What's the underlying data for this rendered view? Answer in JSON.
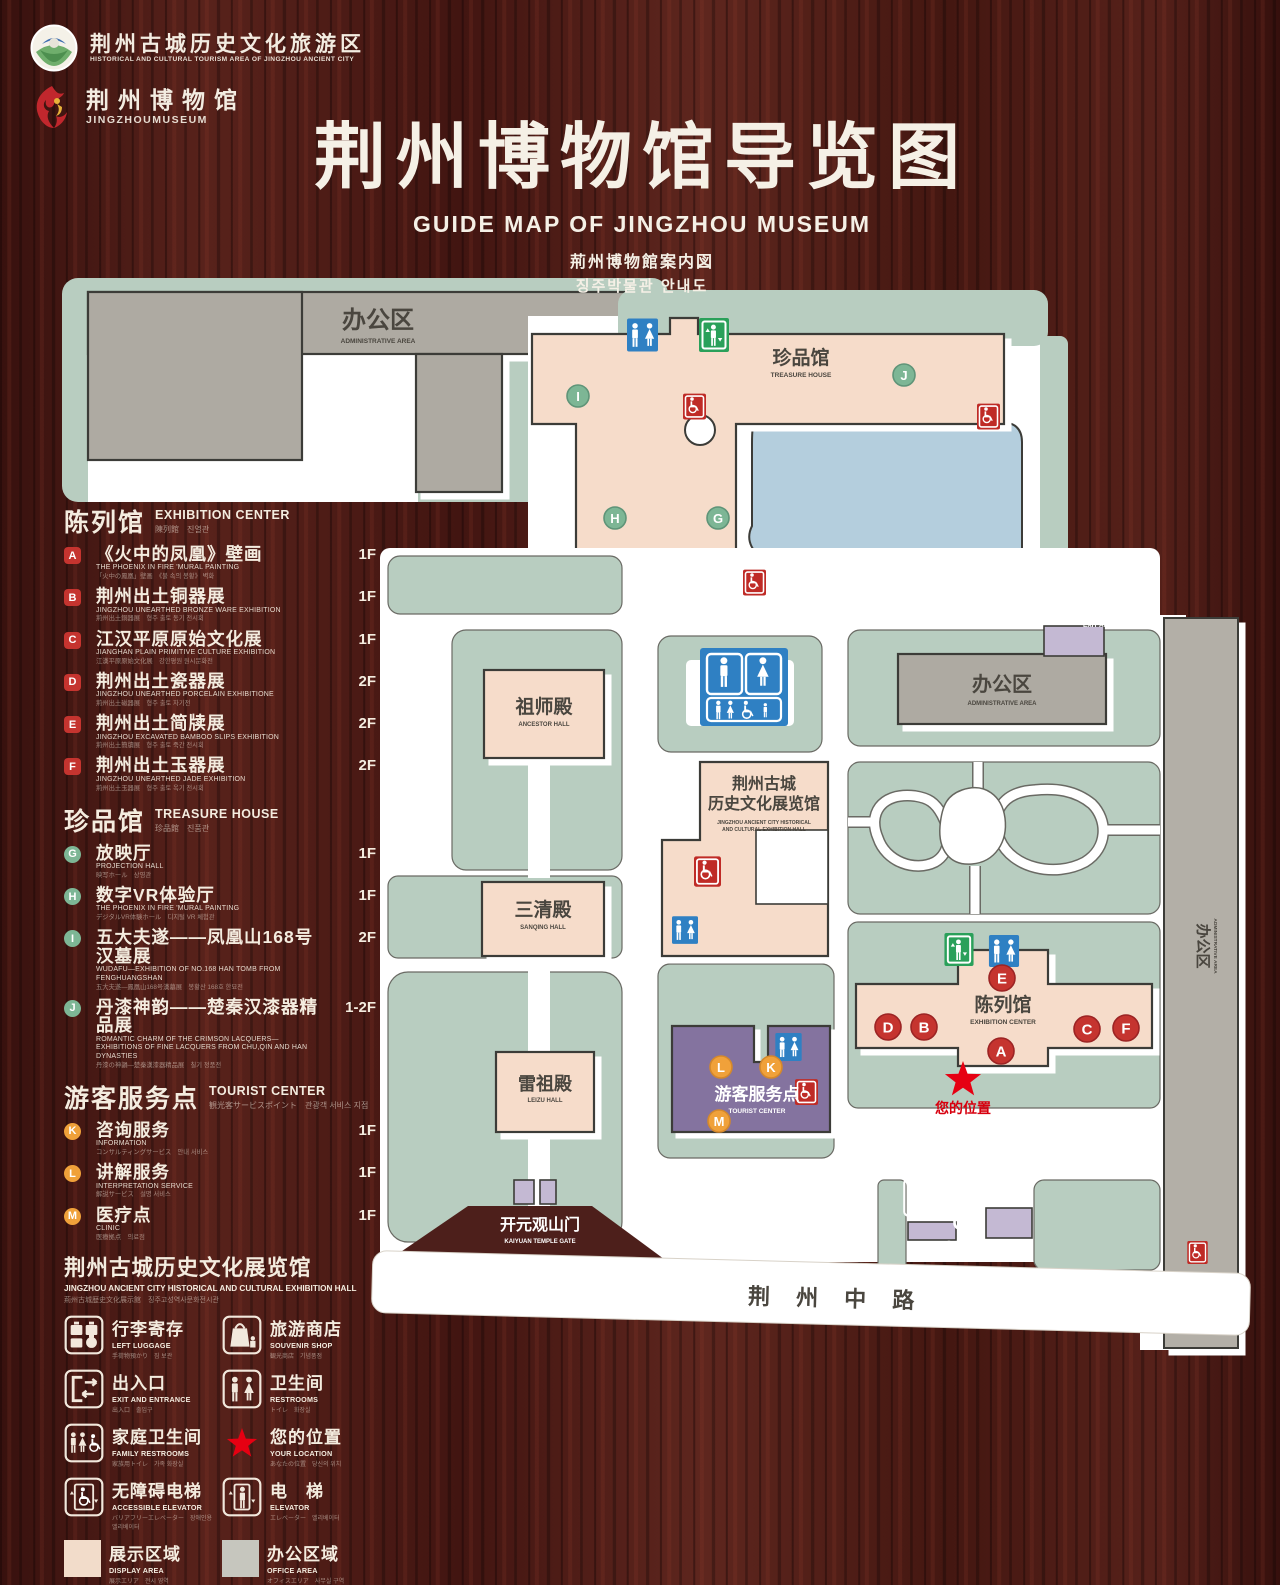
{
  "header": {
    "logo1": {
      "zh": "荆州古城历史文化旅游区",
      "en": "HISTORICAL AND CULTURAL TOURISM AREA OF JINGZHOU ANCIENT CITY"
    },
    "logo2": {
      "zh": "荆州博物馆",
      "en": "JINGZHOUMUSEUM"
    },
    "title_zh": "荆州博物馆导览图",
    "title_en": "GUIDE MAP OF JINGZHOU MUSEUM",
    "title_ja": "荊州博物館案内図",
    "title_ko": "징주박물관 안내도"
  },
  "legend": {
    "sections": [
      {
        "id": "exhibition",
        "title_zh": "陈列馆",
        "title_en": "EXHIBITION CENTER",
        "title_sub": "陳列館　진열관",
        "marker_color": "#c5342f",
        "badge_shape": "square",
        "items": [
          {
            "letter": "A",
            "zh": "《火中的凤凰》壁画",
            "en": "THE PHOENIX IN FIRE 'MURAL PAINTING",
            "sub": "「火中の鳳凰」壁画　《불 속의 봉황》 벽화",
            "floor": "1F"
          },
          {
            "letter": "B",
            "zh": "荆州出土铜器展",
            "en": "JINGZHOU UNEARTHED BRONZE WARE EXHIBITION",
            "sub": "荊州出土銅器展　형주 출토 동기 전시회",
            "floor": "1F"
          },
          {
            "letter": "C",
            "zh": "江汉平原原始文化展",
            "en": "JIANGHAN PLAIN PRIMITIVE CULTURE EXHIBITION",
            "sub": "江漢平原原始文化展　강한평원 원시문화전",
            "floor": "1F"
          },
          {
            "letter": "D",
            "zh": "荆州出土瓷器展",
            "en": "JINGZHOU UNEARTHED PORCELAIN EXHIBITIONE",
            "sub": "荊州出土磁器展　형주 출토 자기전",
            "floor": "2F"
          },
          {
            "letter": "E",
            "zh": "荆州出土简牍展",
            "en": "JINGZHOU EXCAVATED BAMBOO SLIPS EXHIBITION",
            "sub": "荊州出土簡牘展　형주 출토 죽간 전시회",
            "floor": "2F"
          },
          {
            "letter": "F",
            "zh": "荆州出土玉器展",
            "en": "JINGZHOU UNEARTHED JADE EXHIBITION",
            "sub": "荊州出土玉器展　형주 출토 옥기 전시회",
            "floor": "2F"
          }
        ]
      },
      {
        "id": "treasure",
        "title_zh": "珍品馆",
        "title_en": "TREASURE HOUSE",
        "title_sub": "珍品館　진품관",
        "marker_color": "#7db695",
        "badge_shape": "circle",
        "items": [
          {
            "letter": "G",
            "zh": "放映厅",
            "en": "PROJECTION HALL",
            "sub": "映写ホール　상영관",
            "floor": "1F"
          },
          {
            "letter": "H",
            "zh": "数字VR体验厅",
            "en": "THE PHOENIX IN FIRE 'MURAL PAINTING",
            "sub": "デジタルVR体験ホール　디지털 VR 체험관",
            "floor": "1F"
          },
          {
            "letter": "I",
            "zh": "五大夫遂——凤凰山168号汉墓展",
            "en": "WUDAFU—EXHIBITION OF NO.168 HAN TOMB FROM FENGHUANGSHAN",
            "sub": "五大夫遂—鳳凰山168号漢墓展　봉황산 168호 한묘전",
            "floor": "2F"
          },
          {
            "letter": "J",
            "zh": "丹漆神韵——楚秦汉漆器精品展",
            "en": "ROMANTIC CHARM OF THE CRIMSON LACQUERS— EXHIBITIONS OF FINE LACQUERS FROM CHU,QIN AND HAN DYNASTIES",
            "sub": "丹漆の神韻—楚秦漢漆器精品展　칠기 정품전",
            "floor": "1-2F"
          }
        ]
      },
      {
        "id": "tourist",
        "title_zh": "游客服务点",
        "title_en": "TOURIST CENTER",
        "title_sub": "観光客サービスポイント　관광객 서비스 지점",
        "marker_color": "#f0a13a",
        "badge_shape": "circle",
        "items": [
          {
            "letter": "K",
            "zh": "咨询服务",
            "en": "INFORMATION",
            "sub": "コンサルティングサービス　안내 서비스",
            "floor": "1F"
          },
          {
            "letter": "L",
            "zh": "讲解服务",
            "en": "INTERPRETATION SERVICE",
            "sub": "解説サービス　설명 서비스",
            "floor": "1F"
          },
          {
            "letter": "M",
            "zh": "医疗点",
            "en": "CLINIC",
            "sub": "医療拠点　의료점",
            "floor": "1F"
          }
        ]
      }
    ],
    "hall_note": {
      "zh": "荆州古城历史文化展览馆",
      "en": "JINGZHOU ANCIENT CITY HISTORICAL AND CULTURAL EXHIBITION HALL",
      "sub": "荊州古城歴史文化展示館　징주고성역사문화전시관"
    },
    "symbols": [
      {
        "icon": "left-luggage",
        "zh": "行李寄存",
        "en": "LEFT LUGGAGE",
        "sub": "手荷物預かり　짐 보관"
      },
      {
        "icon": "souvenir-shop",
        "zh": "旅游商店",
        "en": "SOUVENIR SHOP",
        "sub": "観光商店　기념품점"
      },
      {
        "icon": "exit-entrance",
        "zh": "出入口",
        "en": "EXIT AND ENTRANCE",
        "sub": "出入口　출입구"
      },
      {
        "icon": "restrooms",
        "zh": "卫生间",
        "en": "RESTROOMS",
        "sub": "トイレ　화장실"
      },
      {
        "icon": "family-restrooms",
        "zh": "家庭卫生间",
        "en": "FAMILY RESTROOMS",
        "sub": "家族用トイレ　가족 화장실"
      },
      {
        "icon": "your-location",
        "zh": "您的位置",
        "en": "YOUR LOCATION",
        "sub": "あなたの位置　당신의 위치"
      },
      {
        "icon": "accessible-elevator",
        "zh": "无障碍电梯",
        "en": "ACCESSIBLE ELEVATOR",
        "sub": "バリアフリーエレベーター　장애인용 엘리베이터"
      },
      {
        "icon": "elevator",
        "zh": "电　梯",
        "en": "ELEVATOR",
        "sub": "エレベーター　엘리베이터"
      },
      {
        "icon": "display-area",
        "zh": "展示区域",
        "en": "DISPLAY AREA",
        "sub": "展示エリア　전시 영역"
      },
      {
        "icon": "office-area",
        "zh": "办公区域",
        "en": "OFFICE AREA",
        "sub": "オフィスエリア　사무실 구역"
      }
    ]
  },
  "map": {
    "marker_colors": {
      "r": "#c5342f",
      "g": "#7db695",
      "o": "#f0a13a"
    },
    "marker_rings": {
      "r": "#9c2424",
      "g": "#5f9478",
      "o": "#d4882b"
    },
    "labels": [
      {
        "id": "admin-tl",
        "zh": "办公区",
        "en": "ADMINISTRATIVE AREA",
        "x": 378,
        "y": 328,
        "fs": 24,
        "efs": 6.5,
        "gap": 15
      },
      {
        "id": "treasure-house",
        "zh": "珍品馆",
        "en": "TREASURE HOUSE",
        "x": 801,
        "y": 364,
        "fs": 19,
        "efs": 6.5,
        "gap": 13
      },
      {
        "id": "ancestor-hall",
        "zh": "祖师殿",
        "en": "ANCESTOR HALL",
        "x": 544,
        "y": 713,
        "fs": 19,
        "efs": 6,
        "gap": 13
      },
      {
        "id": "sanqing-hall",
        "zh": "三清殿",
        "en": "SANQING HALL",
        "x": 543,
        "y": 916,
        "fs": 19,
        "efs": 6,
        "gap": 13
      },
      {
        "id": "leizu-hall",
        "zh": "雷祖殿",
        "en": "LEIZU HALL",
        "x": 545,
        "y": 1090,
        "fs": 18,
        "efs": 6,
        "gap": 12
      },
      {
        "id": "history-hall",
        "zh_lines": [
          "荆州古城",
          "历史文化展览馆"
        ],
        "en_lines": [
          "JINGZHOU ANCIENT CITY HISTORICAL",
          "AND CULTURAL EXHIBITION HALL"
        ],
        "x": 764,
        "y": 789,
        "fs": 16,
        "lh": 20,
        "efs": 5,
        "elh": 7,
        "gap": 15
      },
      {
        "id": "tourist-center",
        "zh": "游客服务点",
        "en": "TOURIST CENTER",
        "x": 757,
        "y": 1100,
        "fs": 17,
        "efs": 6.5,
        "gap": 13,
        "color": "#ffffff"
      },
      {
        "id": "admin-right",
        "zh": "办公区",
        "en": "ADMINISTRATIVE AREA",
        "x": 1002,
        "y": 691,
        "fs": 20,
        "efs": 6,
        "gap": 14
      },
      {
        "id": "exhibition-center",
        "zh": "陈列馆",
        "en": "EXHIBITION CENTER",
        "x": 1003,
        "y": 1011,
        "fs": 19,
        "efs": 6.5,
        "gap": 13
      },
      {
        "id": "admin-strip",
        "zh": "办公区",
        "en": "ADMINISTRATIVE AREA",
        "x": 1198,
        "y": 946,
        "fs": 15,
        "efs": 4.8,
        "gap": 0,
        "rot": 90,
        "ex": 1214,
        "ey": 946
      },
      {
        "id": "exit-top",
        "zh": "出入口",
        "en": "EXIT AND ENTRANCE",
        "x": 1117,
        "y": 613,
        "fs": 18,
        "efs": 6.5,
        "gap": 14,
        "color": "#ffffff"
      },
      {
        "id": "exit-bottom",
        "zh": "出入口",
        "en": "EXIT AND ENTRANCE",
        "x": 969,
        "y": 1258,
        "fs": 20,
        "efs": 7,
        "gap": 15,
        "color": "#ffffff"
      },
      {
        "id": "kaiyuan-gate",
        "zh": "开元观山门",
        "en": "KAIYUAN TEMPLE GATE",
        "x": 540,
        "y": 1230,
        "fs": 16,
        "efs": 6,
        "gap": 13,
        "color": "#ffffff"
      },
      {
        "id": "jingzhou-middle-road",
        "zh": "荆 州 中 路",
        "x": 836,
        "y": 1306,
        "fs": 22,
        "ls": 10,
        "rot": 1.5
      },
      {
        "id": "your-location",
        "zh": "您的位置",
        "x": 963,
        "y": 1113,
        "fs": 14,
        "color": "#d7000f"
      }
    ],
    "markers": [
      {
        "l": "I",
        "x": 578,
        "y": 396,
        "c": "g"
      },
      {
        "l": "J",
        "x": 904,
        "y": 375,
        "c": "g"
      },
      {
        "l": "H",
        "x": 615,
        "y": 518,
        "c": "g"
      },
      {
        "l": "G",
        "x": 718,
        "y": 518,
        "c": "g"
      },
      {
        "l": "E",
        "x": 1002,
        "y": 978,
        "c": "r"
      },
      {
        "l": "D",
        "x": 888,
        "y": 1027,
        "c": "r"
      },
      {
        "l": "B",
        "x": 924,
        "y": 1027,
        "c": "r"
      },
      {
        "l": "C",
        "x": 1087,
        "y": 1029,
        "c": "r"
      },
      {
        "l": "F",
        "x": 1126,
        "y": 1028,
        "c": "r"
      },
      {
        "l": "A",
        "x": 1001,
        "y": 1051,
        "c": "r"
      },
      {
        "l": "L",
        "x": 721,
        "y": 1067,
        "c": "o"
      },
      {
        "l": "K",
        "x": 771,
        "y": 1067,
        "c": "o"
      },
      {
        "l": "M",
        "x": 719,
        "y": 1121,
        "c": "o"
      }
    ],
    "colors": {
      "lawn": "#b8cdc0",
      "display": "#f6dcca",
      "office": "#aeaaa2",
      "pond": "#b4cedd",
      "tourist_purple": "#84739f",
      "gate_purple": "#c4b9d3",
      "outline": "#3c3c38",
      "wc_blue": "#2f80c3",
      "elevator_green": "#2aa05a",
      "accessible_red": "#bf2b26",
      "star_red": "#e60012"
    }
  }
}
